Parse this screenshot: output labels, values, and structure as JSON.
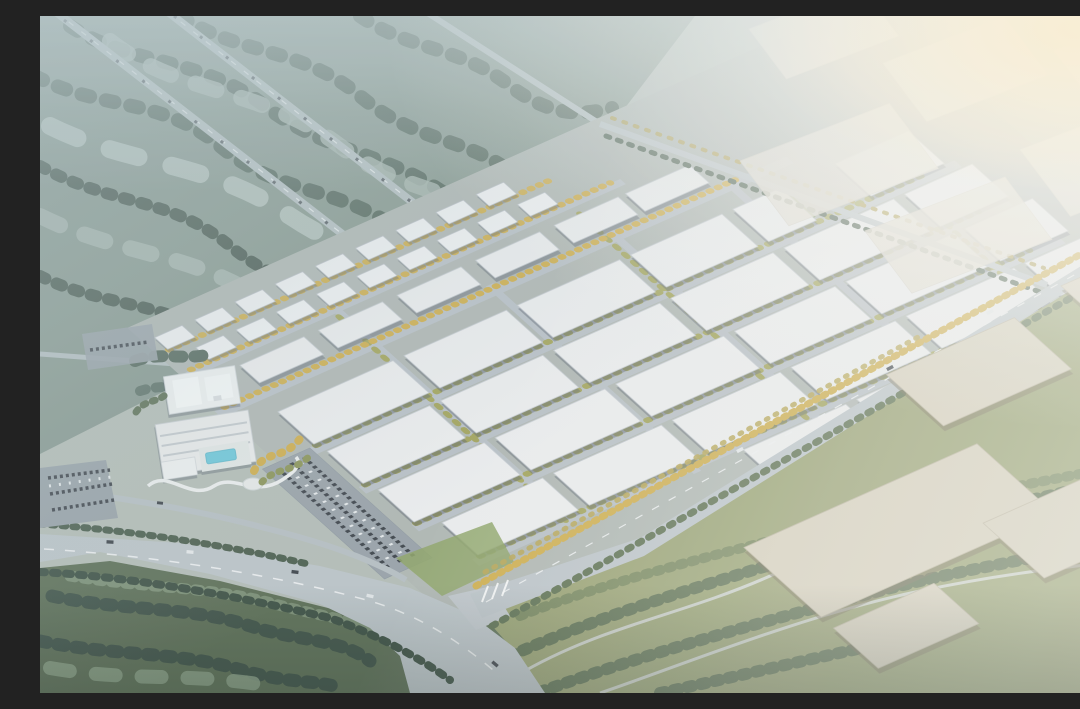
{
  "scene": {
    "type": "aerial-architectural-rendering",
    "description": "Bird's-eye 3D rendering of a large logistics and industrial park: a diagonal grid of white flat-roof warehouses with tree-lined internal streets, two staggered rows of white apartment blocks along the northwest edge, a hotel complex with swimming pool and landscaped winding path at the southwest, parking lots with cars, a wide arterial road junction at the bottom, misty blue-green forest with twin highways at the upper left, dark forest at the lower left, olive scrubland with large tan warehouses at the lower right, and warehouses dissolving into bright warm haze at the upper right.",
    "time_of_day": "hazy morning, sunlight from the upper right",
    "regions": {
      "northwest": "misty forest with twin tree-lined highways",
      "north_center": "small office sheds, sports field and access road on park edge",
      "center": "grid of white warehouse blocks in five diagonal rows",
      "northwest_edge": "staggered white apartment blocks with autumn trees",
      "southwest": "hotel with pool, garden, winding path, conference hall, parking",
      "south": "wide boulevard curving to a major junction with traffic",
      "southeast": "green scrubland with large tan warehouse slabs",
      "northeast": "tan warehouse blocks fading into bright haze"
    },
    "counts": {
      "warehouse_rows": 5,
      "apartment_blocks": 18,
      "shed_blocks": 6
    }
  },
  "palette": {
    "land_base": "#b4bdb7",
    "forest_nw_base": "#87988f",
    "forest_canopy_dark": "#54675c",
    "forest_canopy_deep": "#48594f",
    "forest_canopy_light": "#a9b8b0",
    "forest_mist_pale": "#c2cec9",
    "forest_sw_base": "#5e7058",
    "forest_sw_dark": "#41544a",
    "forest_sw_light": "#7c9077",
    "grass_light": "#8da289",
    "scrub_base": "#98a171",
    "scrub_tree_dark": "#5c6f50",
    "scrub_tree_mid": "#76865c",
    "trail_light": "#ccd1ca",
    "park_ground": "#b0b7b3",
    "park_street": "#b9c0c6",
    "tree_olive": "#a3a45c",
    "tree_yellow": "#cfae4e",
    "tree_dark_green": "#4d6050",
    "warehouse_roof": "#ecedee",
    "warehouse_stroke": "#c6cbd1",
    "residential_white": "#f1f2f3",
    "field_green": "#7f9a5e",
    "road_major": "#bcc4c9",
    "road_junction": "#c0c7cc",
    "lane_white": "#eef1f2",
    "parking_asphalt": "#99a2a9",
    "car_dark": "#3f454c",
    "car_light": "#e4e8ea",
    "highway_grey": "#b4bfc1",
    "tan_roof": "#d7d0bd",
    "tan_stroke": "#bdb5a0",
    "tan_hazy": "#e3ded3",
    "pool_blue": "#6fc8da",
    "path_white": "#eceeee",
    "hotel_white": "#e9ebeb"
  }
}
